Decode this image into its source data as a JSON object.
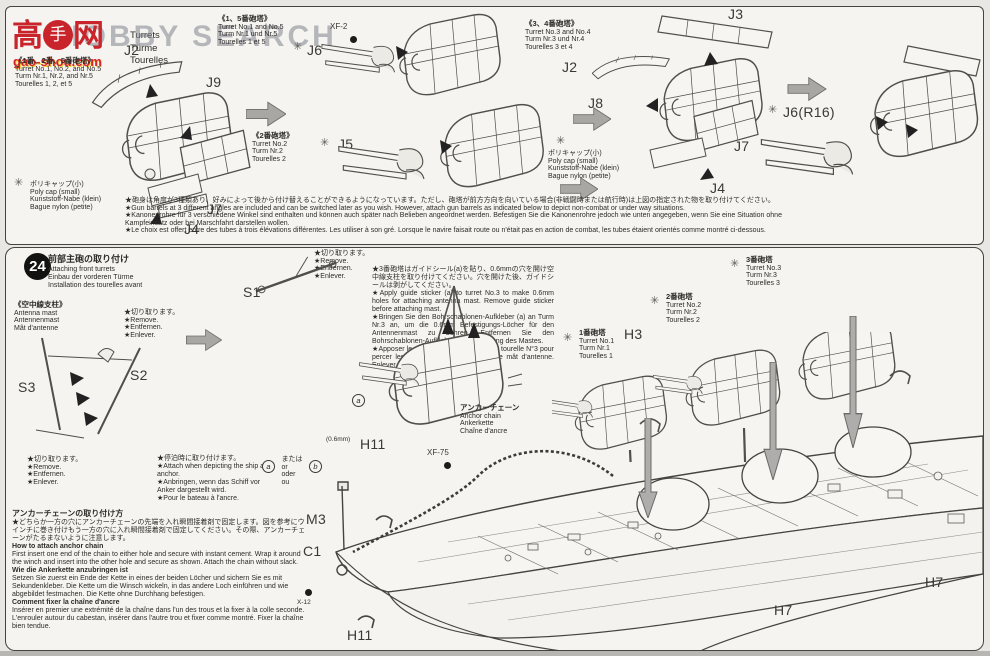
{
  "watermark": {
    "char_left": "高",
    "fist": "手",
    "char_right": "网",
    "domain": "gao-shou.com",
    "overlay": "HOBBY SEARCH"
  },
  "top": {
    "title_rest": [
      "Turrets",
      "Türme",
      "Tourelles"
    ],
    "group_125": {
      "jp": "《1番、2番、5番砲塔》",
      "rest": [
        "Turret No.1, No.2, and No.5",
        "Turm Nr.1, Nr.2, and Nr.5",
        "Tourelles 1, 2, et 5"
      ]
    },
    "group_15": {
      "jp": "《1、5番砲塔》",
      "rest": [
        "Turret No.1 and No.5",
        "Turm Nr.1 und Nr.5",
        "Tourelles 1 et 5"
      ]
    },
    "group_2": {
      "jp": "《2番砲塔》",
      "rest": [
        "Turret No.2",
        "Turm Nr.2",
        "Tourelles 2"
      ]
    },
    "group_34": {
      "jp": "《3、4番砲塔》",
      "rest": [
        "Turret No.3 and No.4",
        "Turm Nr.3 und Nr.4",
        "Tourelles 3 et 4"
      ]
    },
    "polycap": [
      "ポリキャップ(小)",
      "Poly cap (small)",
      "Kunststoff-Nabe (klein)",
      "Bague nylon (petite)"
    ],
    "parts": {
      "j2a": "J2",
      "j9": "J9",
      "j7a": "J7",
      "j4a": "J4",
      "xf2": "XF-2",
      "j6": "J6",
      "j5": "J5",
      "j3": "J3",
      "j2b": "J2",
      "j8": "J8",
      "j7b": "J7",
      "j4b": "J4",
      "j6r16": "J6(R16)"
    },
    "note": [
      "★砲身は角度が3種類あり、好みによって後から付け替えることができるようになっています。ただし、砲塔が前方方向を向いている場合(非戦闘時または航行時)は上図の指定された物を取り付けてください。",
      "★Gun barrels at 3 different angles are included and can be switched later as you wish. However, attach gun barrels as indicated below to depict non-combat or under way situations.",
      "★Kanonenrohre für 3 verschiedene Winkel sind enthalten und können auch später nach Belieben angeordnet werden. Befestigen Sie die Kanonenrohre jedoch wie unten angegeben, wenn Sie eine Situation ohne",
      "Kampfeinsatz oder bei Marschfahrt darstellen wollen.",
      "★Le choix est offert entre des tubes à trois élévations différentes. Les utiliser à son gré. Lorsque le navire faisait route ou n'était pas en action de combat, les tubes étaient orientés comme montré ci-dessous."
    ]
  },
  "step24": {
    "number": "24",
    "title_jp": "前部主砲の取り付け",
    "title_rest": [
      "Attaching front turrets",
      "Einbau der vorderen Türme",
      "Installation des tourelles avant"
    ],
    "antenna_jp": "《空中線支柱》",
    "antenna_rest": [
      "Antenna mast",
      "Antennenmast",
      "Mât d'antenne"
    ],
    "remove_note": [
      "★切り取ります。",
      "★Remove.",
      "★Entfernen.",
      "★Enlever."
    ],
    "sticker_note": [
      "★3番砲塔はガイドシール(a)を貼り、0.6mmの穴を開け空中線支柱を取り付けてください。穴を開けた後、ガイドシールは剥がしてください。",
      "★Apply guide sticker (a) to turret No.3 to make 0.6mm holes for attaching antenna mast. Remove guide sticker before attaching mast.",
      "★Bringen Sie den Bohrschablonen-Aufkleber (a) an Turm Nr.3 an, um die 0.6mm Befestigungs-Löcher für den Antennenmast zu bohren. Entfernen Sie den Bohrschablonen-Aufkleber vor Anbringung des Mastes.",
      "★Apposer le sticker de repérage (a) à la tourelle N°3 pour percer les trous de 0.6mm pour fixer le mât d'antenne. Enlever le sticker avant de fixer le mât."
    ],
    "turret1": [
      "1番砲塔",
      "Turret No.1",
      "Turm Nr.1",
      "Tourelles 1"
    ],
    "turret2": [
      "2番砲塔",
      "Turret No.2",
      "Turm Nr.2",
      "Tourelles 2"
    ],
    "turret3": [
      "3番砲塔",
      "Turret No.3",
      "Turm Nr.3",
      "Tourelles 3"
    ],
    "anchor_chain": [
      "アンカーチェーン",
      "Anchor chain",
      "Ankerkette",
      "Chaîne d'ancre"
    ],
    "at_anchor": [
      "★停泊時に取り付けます。",
      "★Attach when depicting the ship at anchor.",
      "★Anbringen, wenn das Schiff vor Anker dargestellt wird.",
      "★Pour le bateau à l'ancre."
    ],
    "or": {
      "a": "a",
      "b": "b",
      "words": [
        "または",
        "or",
        "oder",
        "ou"
      ]
    },
    "sticker_a": "a",
    "howto": {
      "jp_title": "アンカーチェーンの取り付け方",
      "jp_body": "★どちらか一方の穴にアンカーチェーンの先端を入れ瞬間接着剤で固定します。図を参考にウインチに巻き付けもう一方の穴に入れ瞬間接着剤で固定してください。その際、アンカーチェーンがたるまないように注意します。",
      "en_title": "How to attach anchor chain",
      "en_body": "First insert one end of the chain to either hole and secure with instant cement. Wrap it around the winch and insert into the other hole and secure as shown. Attach the chain without slack.",
      "de_title": "Wie die Ankerkette anzubringen ist",
      "de_body": "Setzen Sie zuerst ein Ende der Kette in eines der beiden Löcher und sichern Sie es mit Sekundenkleber. Die Kette um die Winsch wickeln, in das andere Loch einführen und wie abgebildet festmachen. Die Kette ohne Durchhang befestigen.",
      "fr_title": "Comment fixer la chaîne d'ancre",
      "fr_body": "Insérer en premier une extrémité de la chaîne dans l'un des trous et la fixer à la colle seconde. L'enrouler autour du cabestan, insérer dans l'autre trou et fixer comme montré. Fixer la chaîne bien tendue."
    },
    "parts": {
      "s1": "S1",
      "s2": "S2",
      "s3": "S3",
      "m3": "M3",
      "c1": "C1",
      "x12": "X-12",
      "h11": "H11",
      "h3": "H3",
      "h7": "H7",
      "xf75": "XF-75",
      "mm06": "(0.6mm)"
    }
  },
  "colors": {
    "paper": "#f5f4f0",
    "line": "#504f4a",
    "accent_red": "#c9242b",
    "watermark_grey": "#7d838e"
  }
}
